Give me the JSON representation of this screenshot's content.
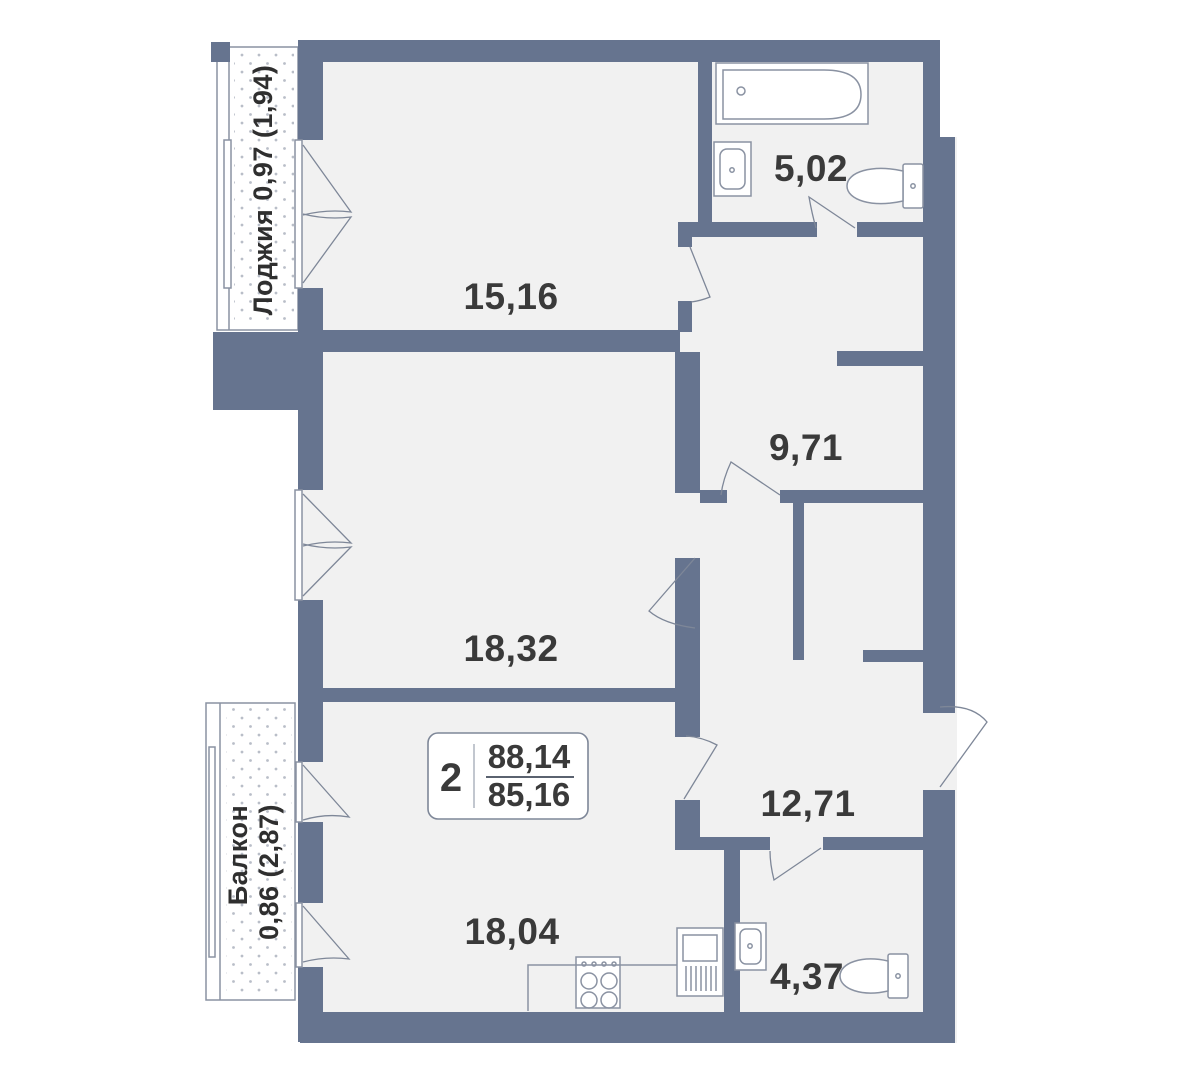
{
  "plan": {
    "summary": {
      "rooms_count": "2",
      "total_area": "88,14",
      "living_area": "85,16"
    },
    "rooms": [
      {
        "id": "living-room",
        "area": "15,16"
      },
      {
        "id": "bathroom",
        "area": "5,02"
      },
      {
        "id": "hall",
        "area": "9,71"
      },
      {
        "id": "bedroom",
        "area": "18,32"
      },
      {
        "id": "entrance-corridor",
        "area": "12,71"
      },
      {
        "id": "kitchen-living",
        "area": "18,04"
      },
      {
        "id": "wc",
        "area": "4,37"
      }
    ],
    "loggia": {
      "label": "Лоджия 0,97 (1,94)"
    },
    "balcony": {
      "name": "Балкон",
      "value": "0,86 (2,87)"
    },
    "colors": {
      "wall": "#66748F",
      "floor": "#F1F1F1",
      "outline": "#8A92A2",
      "text": "#3A3A3A"
    }
  }
}
